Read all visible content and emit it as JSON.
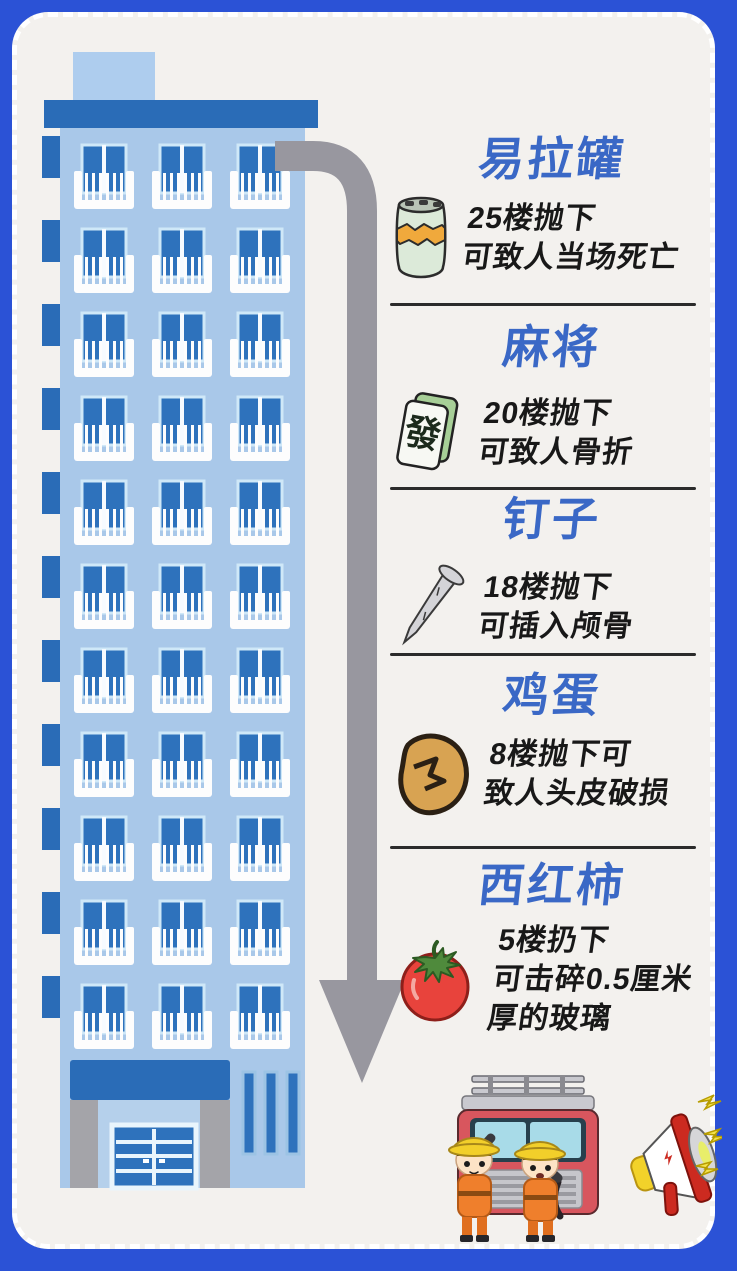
{
  "poster": {
    "items": [
      {
        "title": "易拉罐",
        "icon": "soda-can-icon",
        "desc": "25楼抛下\n可致人当场死亡"
      },
      {
        "title": "麻将",
        "icon": "mahjong-tile-icon",
        "tile_char": "發",
        "desc": "20楼抛下\n可致人骨折"
      },
      {
        "title": "钉子",
        "icon": "nail-icon",
        "desc": "18楼抛下\n可插入颅骨"
      },
      {
        "title": "鸡蛋",
        "icon": "egg-icon",
        "desc": "8楼抛下可\n致人头皮破损"
      },
      {
        "title": "西红柿",
        "icon": "tomato-icon",
        "desc": "5楼扔下\n可击碎0.5厘米\n厚的玻璃"
      }
    ],
    "colors": {
      "frame_blue": "#2b52d6",
      "card_bg": "#f3f1ee",
      "title_blue": "#3a68c6",
      "text_black": "#181818",
      "building_facade": "#a9c8e9",
      "building_dark_blue": "#2a6cb7",
      "window_blue": "#2e72bc",
      "arrow_gray": "#98979f",
      "can_green": "#dcead9",
      "can_band_orange": "#f0a93c",
      "egg_brown": "#d8a352",
      "tomato_red": "#e8433c",
      "helmet_yellow": "#f2cf2a",
      "uniform_orange": "#ef7f2c"
    }
  }
}
